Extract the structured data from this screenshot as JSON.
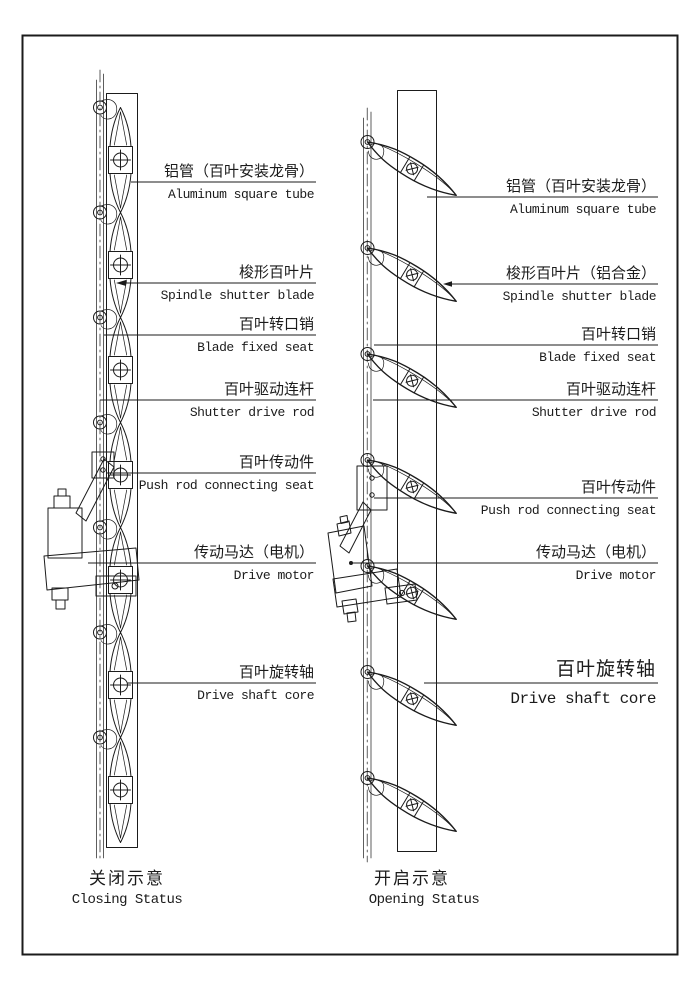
{
  "colors": {
    "line": "#1b1b1b",
    "background": "#ffffff"
  },
  "diagrams": {
    "left": {
      "caption_zh": "关闭示意",
      "caption_en": "Closing Status",
      "labels": [
        {
          "zh": "铝管（百叶安装龙骨）",
          "en": "Aluminum square tube"
        },
        {
          "zh": "梭形百叶片",
          "en": "Spindle shutter blade"
        },
        {
          "zh": "百叶转口销",
          "en": "Blade fixed seat"
        },
        {
          "zh": "百叶驱动连杆",
          "en": "Shutter drive rod"
        },
        {
          "zh": "百叶传动件",
          "en": "Push rod connecting seat"
        },
        {
          "zh": "传动马达（电机）",
          "en": "Drive motor"
        },
        {
          "zh": "百叶旋转轴",
          "en": "Drive shaft core"
        }
      ]
    },
    "right": {
      "caption_zh": "开启示意",
      "caption_en": "Opening Status",
      "labels": [
        {
          "zh": "铝管（百叶安装龙骨）",
          "en": "Aluminum square tube"
        },
        {
          "zh": "梭形百叶片（铝合金）",
          "en": "Spindle shutter blade"
        },
        {
          "zh": "百叶转口销",
          "en": "Blade fixed seat"
        },
        {
          "zh": "百叶驱动连杆",
          "en": "Shutter drive rod"
        },
        {
          "zh": "百叶传动件",
          "en": "Push rod connecting seat"
        },
        {
          "zh": "传动马达（电机）",
          "en": "Drive motor"
        },
        {
          "zh": "百叶旋转轴",
          "en": "Drive shaft core"
        }
      ]
    }
  }
}
